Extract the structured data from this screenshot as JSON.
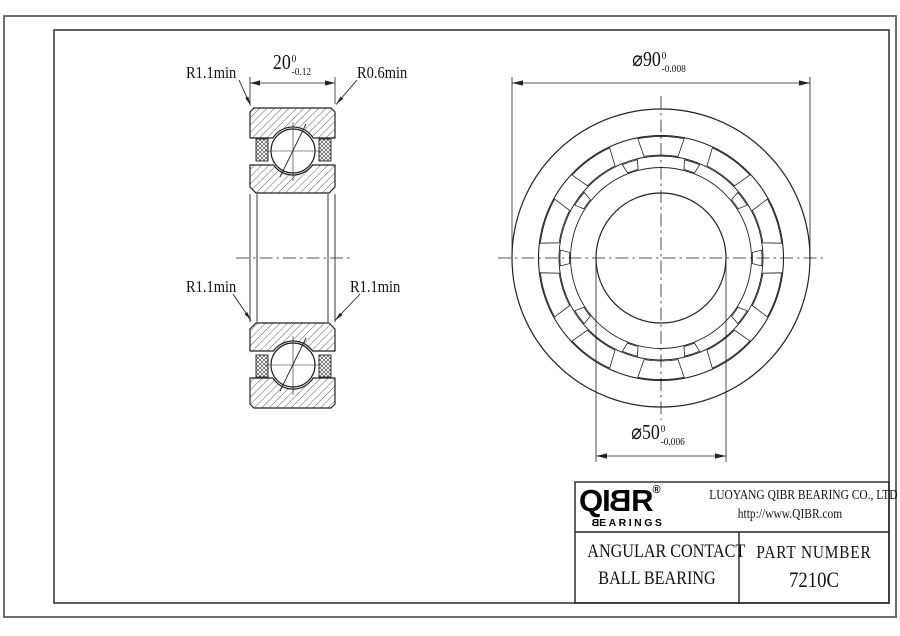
{
  "colors": {
    "background": "#ffffff",
    "line": "#222222",
    "text": "#111111"
  },
  "annotations": {
    "radius_top_left": "R1.1min",
    "radius_top_right": "R0.6min",
    "radius_mid_left": "R1.1min",
    "radius_mid_right": "R1.1min"
  },
  "dimensions": {
    "width": {
      "prefix": "",
      "value": "20",
      "upper_tol": "0",
      "lower_tol": "-0.12"
    },
    "outer_diameter": {
      "prefix": "⌀",
      "value": "90",
      "upper_tol": "0",
      "lower_tol": "-0.008"
    },
    "bore_diameter": {
      "prefix": "⌀",
      "value": "50",
      "upper_tol": "0",
      "lower_tol": "-0.006"
    }
  },
  "title_block": {
    "logo_text": "QIBR",
    "logo_registered": "®",
    "logo_subtext": "BEARINGS",
    "company_name": "LUOYANG QIBR BEARING CO., LTD",
    "company_website": "http://www.QIBR.com",
    "product_line1": "ANGULAR CONTACT",
    "product_line2": "BALL BEARING",
    "part_number_label": "PART NUMBER",
    "part_number": "7210C"
  }
}
